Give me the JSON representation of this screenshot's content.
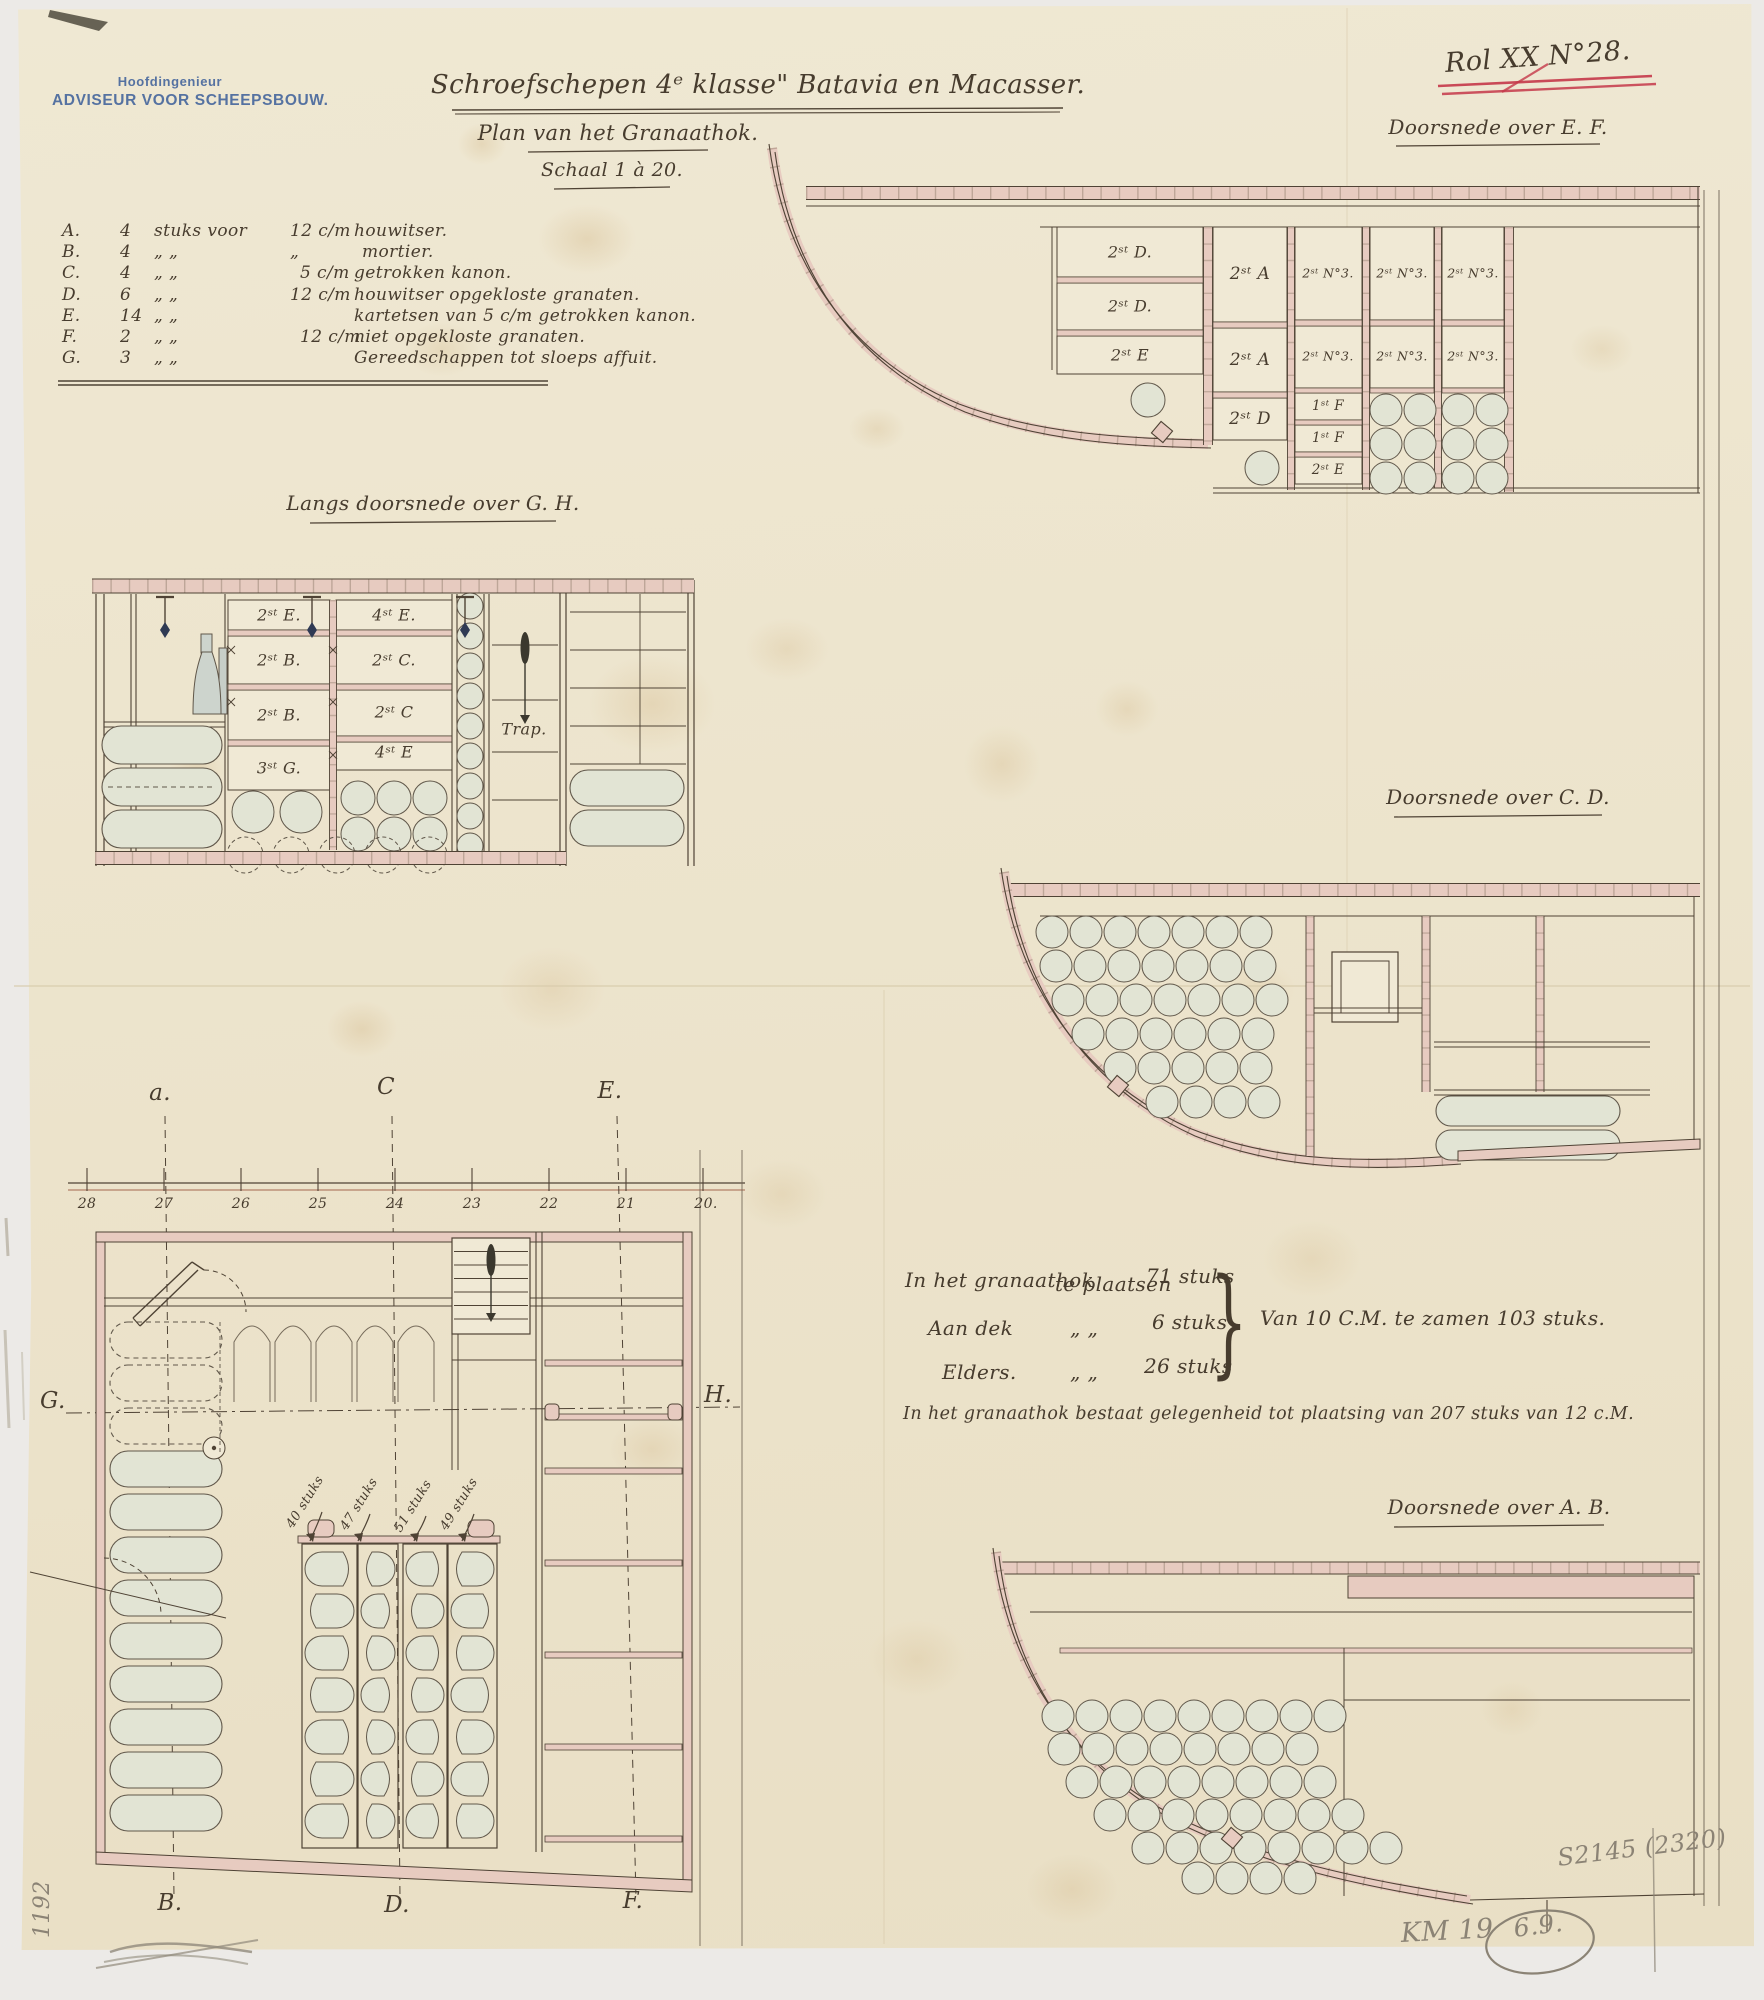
{
  "colors": {
    "paper": "#ece3cb",
    "ink": "#473c2e",
    "pink": "#e7cbc0",
    "stamp_blue": "#40629b",
    "red": "#c5394a",
    "pencil": "#8b8375",
    "shell_fill": "#e2e4d4"
  },
  "stamp": {
    "line1": "Hoofdingenieur",
    "line2": "ADVISEUR VOOR SCHEEPSBOUW."
  },
  "rol_mark": "Rol XX N°28.",
  "header": {
    "title": "Schroefschepen 4ᵉ klasse\" Batavia en Macasser.",
    "subtitle": "Plan van het Granaathok.",
    "scale_label": "Schaal 1 à 20."
  },
  "legend": {
    "rows": [
      {
        "k": "A.",
        "q": "4",
        "d1": "stuks voor",
        "cal": "12 c/m",
        "desc": "houwitser."
      },
      {
        "k": "B.",
        "q": "4",
        "d1": "„      „",
        "cal": "„",
        "desc": "mortier."
      },
      {
        "k": "C.",
        "q": "4",
        "d1": "„      „",
        "cal": "5 c/m",
        "desc": "getrokken kanon."
      },
      {
        "k": "D.",
        "q": "6",
        "d1": "„      „",
        "cal": "12 c/m",
        "desc": "houwitser opgekloste granaten."
      },
      {
        "k": "E.",
        "q": "14",
        "d1": "„      „",
        "cal": "",
        "desc": "kartetsen van 5 c/m getrokken kanon."
      },
      {
        "k": "F.",
        "q": "2",
        "d1": "„      „",
        "cal": "12 c/m",
        "desc": "niet opgekloste granaten."
      },
      {
        "k": "G.",
        "q": "3",
        "d1": "„      „",
        "cal": "",
        "desc": "Gereedschappen tot sloeps affuit."
      }
    ]
  },
  "ef": {
    "title": "Doorsnede over E. F.",
    "cells": [
      "2ˢᵗ D.",
      "2ˢᵗ D.",
      "2ˢᵗ E",
      "2ˢᵗ A",
      "2ˢᵗ A",
      "2ˢᵗ D",
      "2ˢᵗ N°3.",
      "2ˢᵗ N°3.",
      "1ˢᵗ F",
      "1ˢᵗ F",
      "2ˢᵗ E",
      "2ˢᵗ N°3.",
      "2ˢᵗ N°3.",
      "2ˢᵗ N°3.",
      "2ˢᵗ N°3."
    ]
  },
  "gh": {
    "title": "Langs doorsnede over G. H.",
    "cells": [
      "2ˢᵗ E.",
      "2ˢᵗ B.",
      "2ˢᵗ B.",
      "3ˢᵗ G.",
      "4ˢᵗ E.",
      "2ˢᵗ C.",
      "2ˢᵗ C",
      "4ˢᵗ E"
    ],
    "trap": "Trap."
  },
  "cd": {
    "title": "Doorsnede over C. D."
  },
  "ab": {
    "title": "Doorsnede over A. B."
  },
  "plan": {
    "top_labels": [
      "a.",
      "C",
      "E."
    ],
    "bottom_labels": [
      "B.",
      "D.",
      "F."
    ],
    "left_label": "G.",
    "right_label": "H.",
    "frames": [
      "28",
      "27",
      "26",
      "25",
      "24",
      "23",
      "22",
      "21",
      "20."
    ],
    "rack_counts": [
      "40 stuks",
      "47 stuks",
      "51 stuks",
      "49 stuks"
    ]
  },
  "notes": {
    "r1": [
      "In het granaathok",
      "te plaatsen",
      "71 stuks"
    ],
    "r2": [
      "Aan dek",
      "„      „",
      "6 stuks"
    ],
    "r3": [
      "Elders.",
      "„      „",
      "26 stuks"
    ],
    "brace": "}",
    "summary": "Van 10 C.M. te zamen 103 stuks.",
    "footnote": "In het granaathok bestaat gelegenheid tot plaatsing van 207 stuks van 12 c.M."
  },
  "pencil": {
    "catalog": "S2145 (2320)",
    "km": "KM 19",
    "circled": "6.9.",
    "number": "1192"
  }
}
